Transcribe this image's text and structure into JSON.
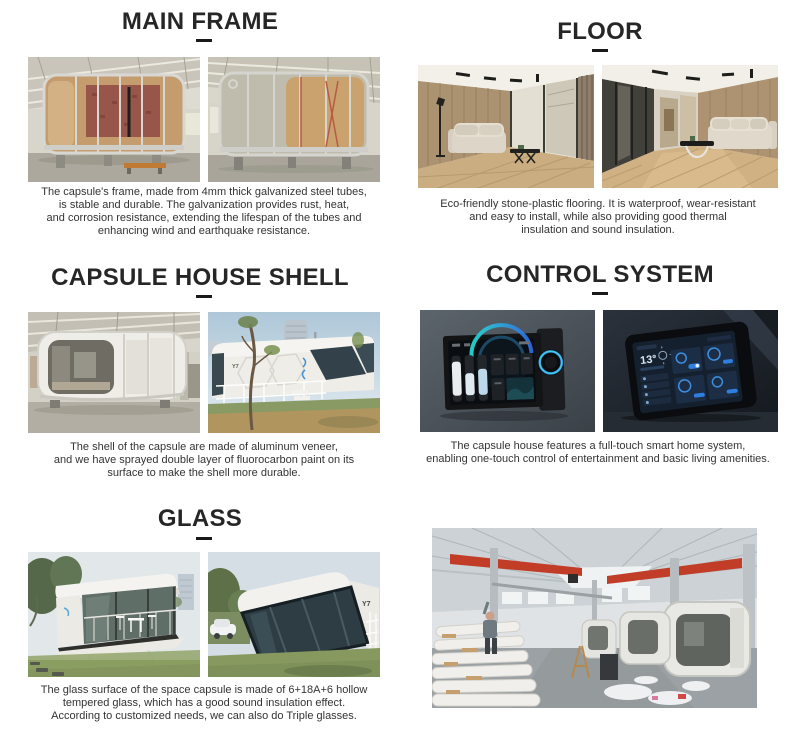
{
  "style": {
    "title_color": "#262626",
    "text_color": "#333333",
    "underline_color": "#1a1a1a",
    "background": "#ffffff"
  },
  "sections": {
    "main_frame": {
      "title": "MAIN FRAME",
      "description": "The capsule's frame, made from 4mm thick galvanized steel tubes,\nis stable and durable. The galvanization provides rust, heat,\nand corrosion resistance, extending the lifespan of the tubes and\nenhancing wind and earthquake resistance.",
      "photos": [
        "steel-frame-capsule-side-view-in-workshop",
        "steel-frame-capsule-angle-view-in-workshop"
      ]
    },
    "floor": {
      "title": "FLOOR",
      "description": "Eco-friendly stone-plastic flooring. It is waterproof, wear-resistant\nand easy to install, while also providing good thermal\ninsulation and sound insulation.",
      "photos": [
        "interior-living-room-wood-floor-sofa",
        "interior-wide-room-wood-floor-sofa"
      ]
    },
    "shell": {
      "title": "CAPSULE HOUSE SHELL",
      "description": "The shell of the capsule are made of aluminum veneer,\nand we have sprayed double layer of fluorocarbon paint on its\nsurface to make the shell more durable.",
      "capsule_model_label": "Y7",
      "photos": [
        "white-capsule-shell-in-workshop",
        "white-capsule-shell-outdoor"
      ]
    },
    "control": {
      "title": "CONTROL SYSTEM",
      "description": "The capsule house features a full-touch smart home system,\nenabling one-touch control of entertainment and basic living amenities.",
      "panel_temperature": "13°",
      "photos": [
        "wall-mounted-smart-control-panel",
        "smart-home-tablet-dashboard"
      ]
    },
    "glass": {
      "title": "GLASS",
      "description": "The glass surface of the space capsule is made of 6+18A+6 hollow\ntempered glass, which has a good sound insulation effect.\nAccording to customized needs, we can also do Triple glasses.",
      "capsule_model_label": "Y7",
      "photos": [
        "glass-capsule-house-terrace-view",
        "glass-capsule-house-front-glass-view"
      ]
    },
    "factory": {
      "photos": [
        "capsule-factory-assembly-line"
      ]
    }
  }
}
